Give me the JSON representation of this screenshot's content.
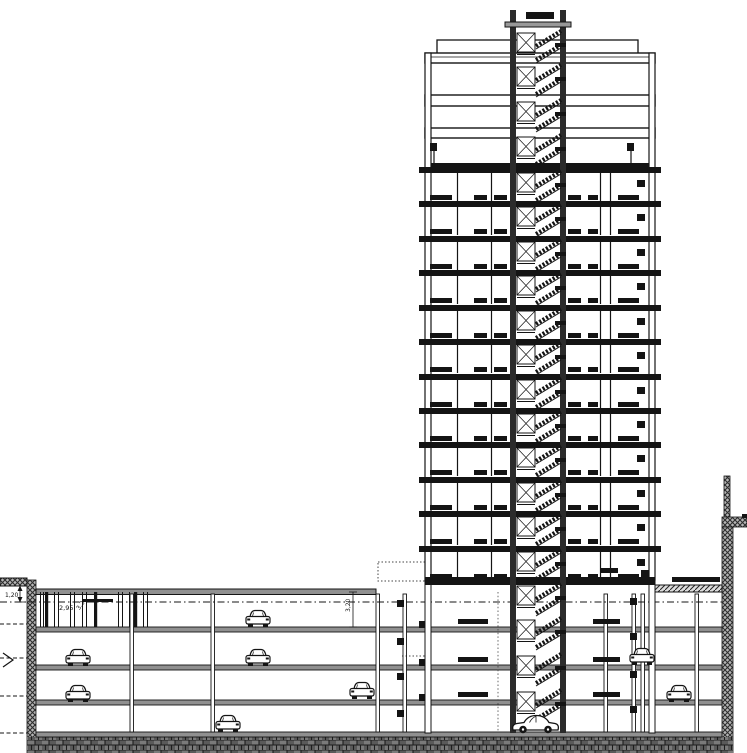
{
  "title": "High-rise building section with 4-level underground parking (CAD drawing)",
  "palette": {
    "paper": "#ffffff",
    "ink": "#141414",
    "slab_gray": "#909090",
    "soil_gray": "#6f6f6f",
    "hatch_gray": "#b5b5b5"
  },
  "annotations": {
    "dim_left_vertical": "1,20",
    "dim_clear_left": "2,95",
    "dim_left_small": "3,2",
    "dim_center_vertical": "3,20"
  },
  "tower": {
    "floor_slab_ys": [
      167,
      201,
      236,
      270,
      305,
      339,
      374,
      408,
      442,
      477,
      511,
      546
    ],
    "flags": [
      {
        "x": 430,
        "y": 143
      },
      {
        "x": 627,
        "y": 143
      }
    ]
  },
  "core": {
    "story_ys": [
      27,
      61,
      96,
      131,
      167,
      201,
      236,
      270,
      305,
      339,
      374,
      408,
      442,
      477,
      511,
      546,
      580,
      614,
      650,
      686
    ]
  },
  "garage": {
    "columns_x": [
      130,
      211,
      376,
      403,
      604,
      632,
      641,
      695
    ],
    "entry_posts_thin_x": [
      40,
      43,
      54,
      58,
      70,
      74,
      82,
      86,
      118,
      122,
      129,
      143,
      147
    ],
    "entry_posts_thick_x": [
      45,
      94,
      134
    ],
    "wall_bar_ys": [
      619,
      657,
      692
    ],
    "squares_right_x": 630,
    "squares_right_ys": [
      598,
      633,
      671,
      706
    ],
    "squares_tower_x": 419,
    "squares_tower_ys": [
      621,
      659,
      694
    ],
    "squares_mid_x": 397,
    "squares_mid_ys": [
      600,
      638,
      673,
      710
    ],
    "ground_bars": [
      {
        "x": 600,
        "y": 568,
        "w": 18,
        "h": 5
      },
      {
        "x": 672,
        "y": 577,
        "w": 48,
        "h": 5
      },
      {
        "x": 641,
        "y": 570,
        "w": 8,
        "h": 8
      },
      {
        "x": 82,
        "y": 599,
        "w": 31,
        "h": 3
      }
    ]
  },
  "site": {
    "margin_dash_ys": [
      624,
      658,
      696,
      733
    ]
  },
  "cars": [
    {
      "type": "front",
      "x": 245,
      "y": 609
    },
    {
      "type": "front",
      "x": 65,
      "y": 648
    },
    {
      "type": "front",
      "x": 245,
      "y": 648
    },
    {
      "type": "front",
      "x": 629,
      "y": 647
    },
    {
      "type": "front",
      "x": 65,
      "y": 684
    },
    {
      "type": "front",
      "x": 349,
      "y": 681
    },
    {
      "type": "front",
      "x": 666,
      "y": 684
    },
    {
      "type": "front",
      "x": 215,
      "y": 714
    },
    {
      "type": "side",
      "x": 511,
      "y": 711
    }
  ]
}
